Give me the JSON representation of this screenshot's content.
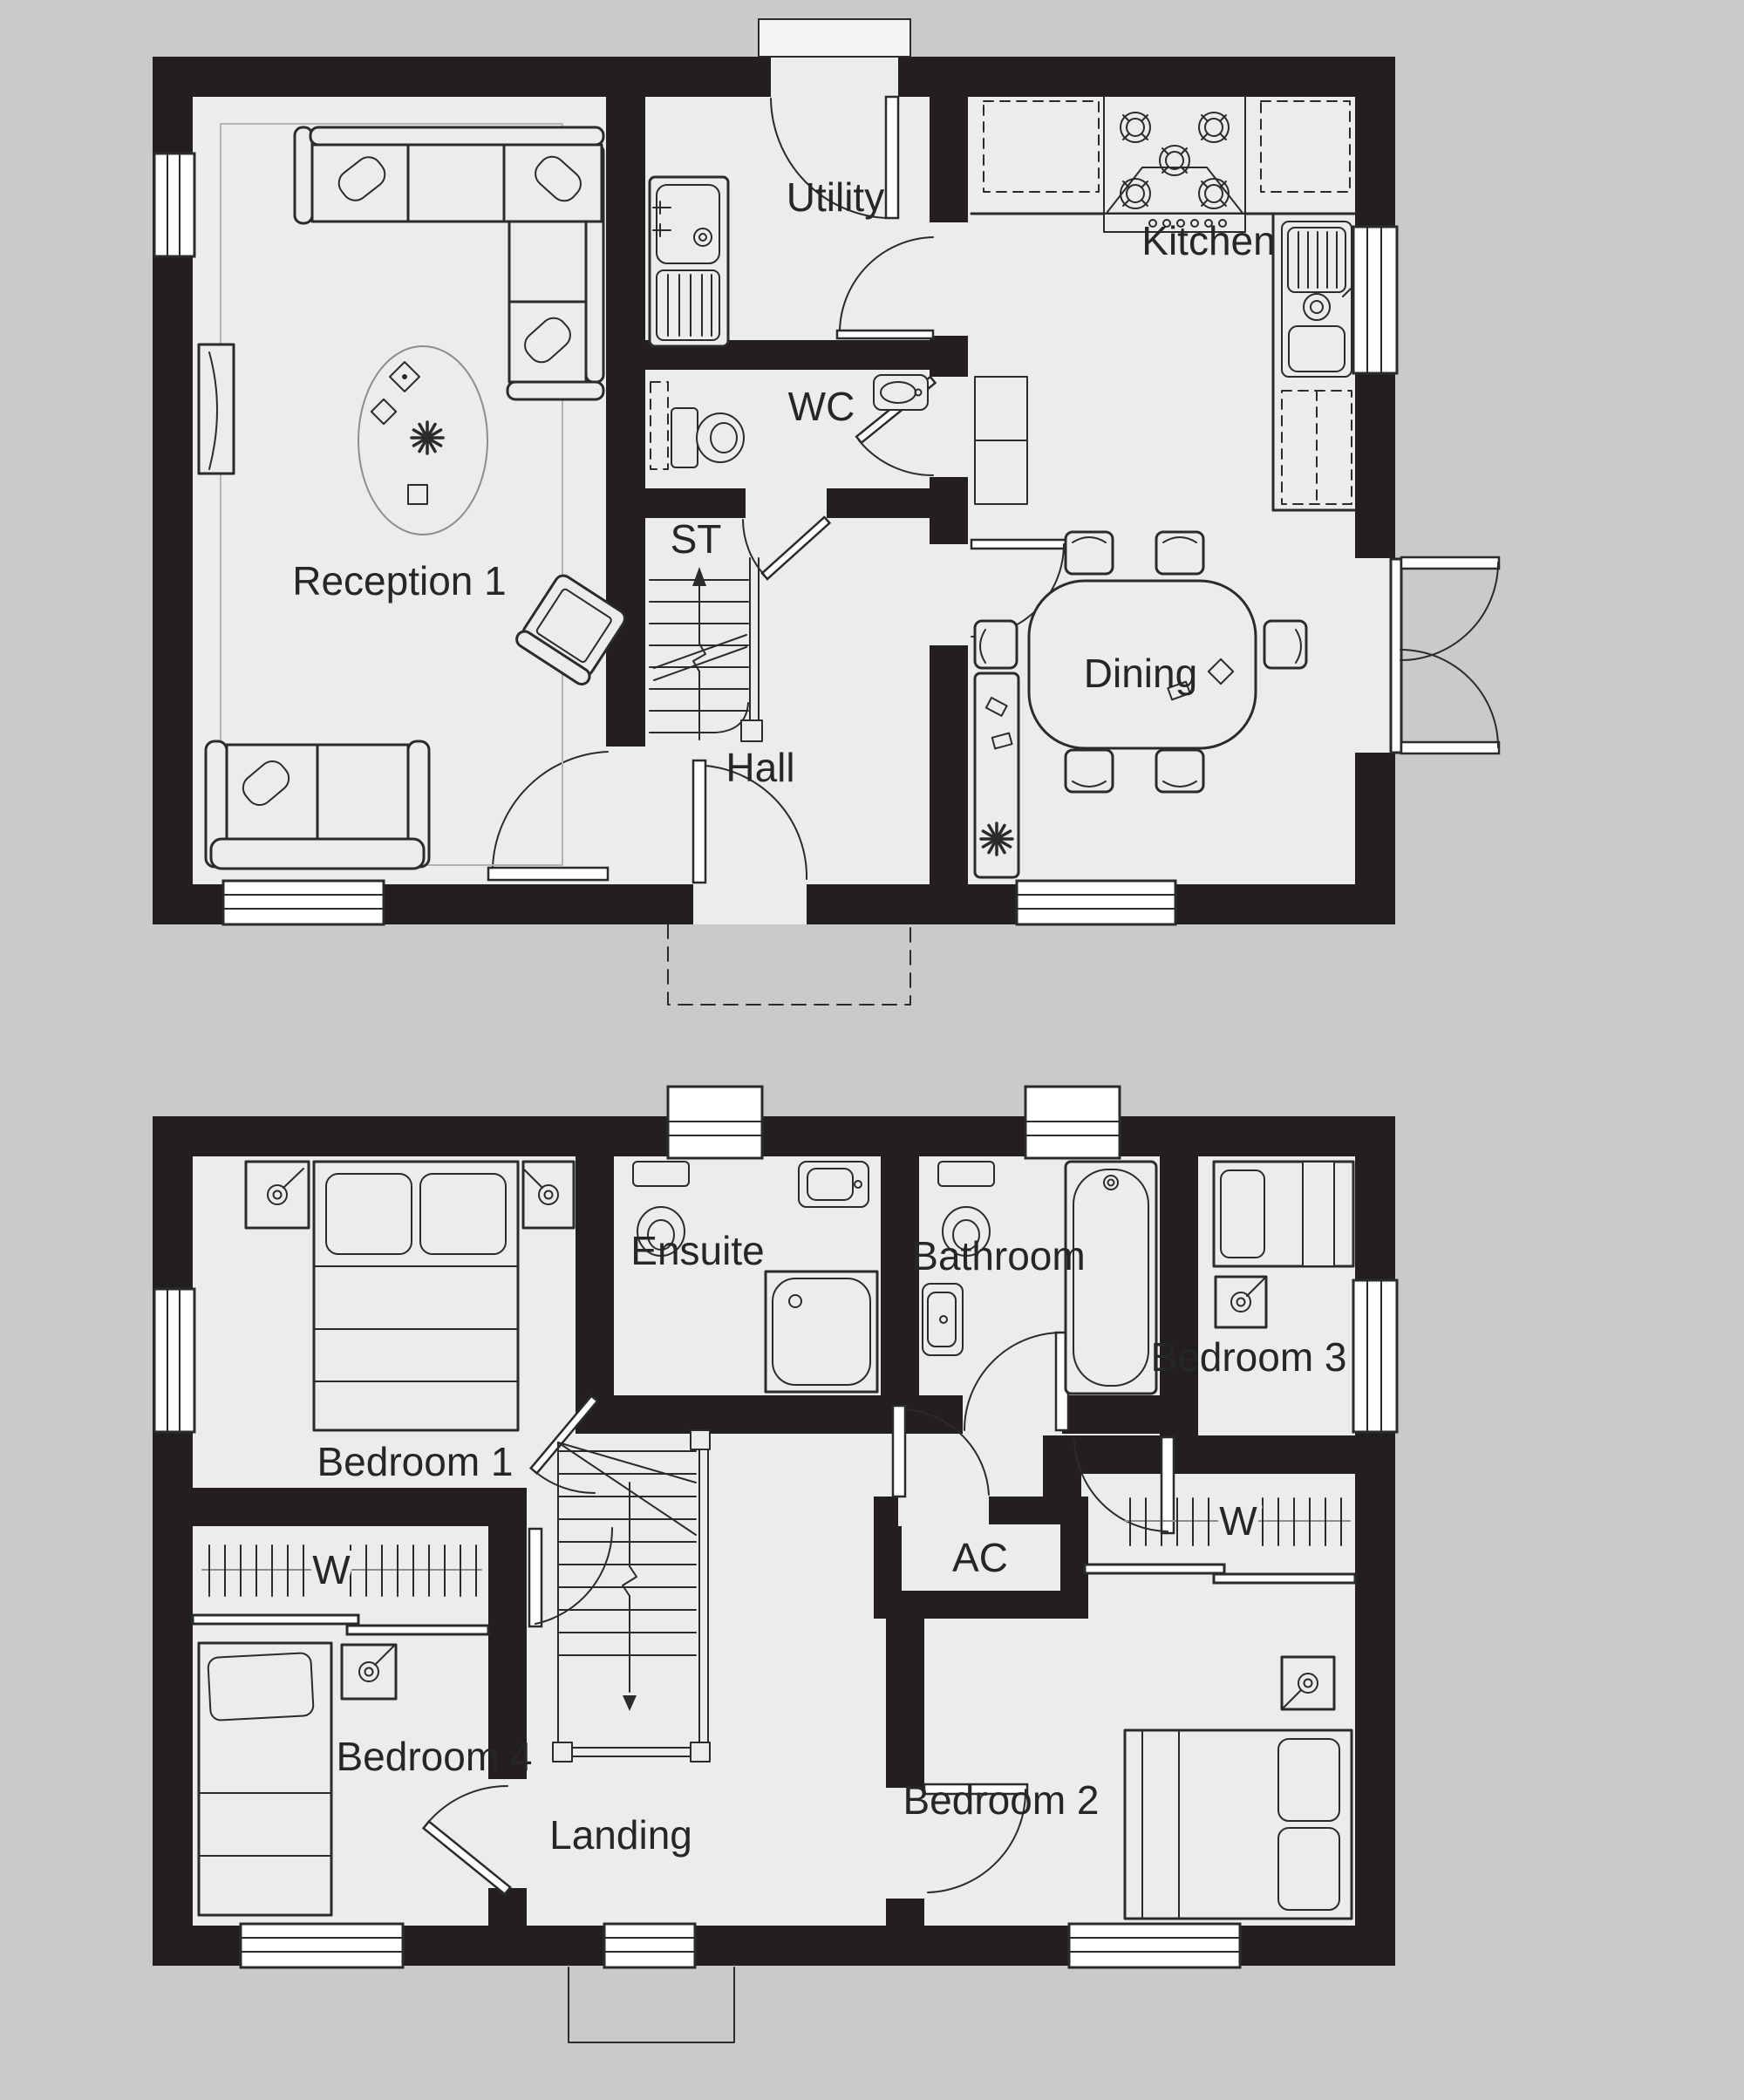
{
  "palette": {
    "background": "#cacaca",
    "floor_fill": "#ececec",
    "wall_fill": "#231f20",
    "line": "#2b2b2b",
    "window_fill": "#ffffff",
    "rug_outline": "#8d8d8d"
  },
  "floors": {
    "ground": {
      "rooms": [
        {
          "label": "Reception 1"
        },
        {
          "label": "Utility"
        },
        {
          "label": "WC"
        },
        {
          "label": "ST"
        },
        {
          "label": "Hall"
        },
        {
          "label": "Kitchen"
        },
        {
          "label": "Dining"
        }
      ]
    },
    "first": {
      "rooms": [
        {
          "label": "Bedroom 1"
        },
        {
          "label": "Ensuite"
        },
        {
          "label": "Bathroom"
        },
        {
          "label": "Bedroom 3"
        },
        {
          "label": "Bedroom 4"
        },
        {
          "label": "Bedroom 2"
        },
        {
          "label": "Landing"
        },
        {
          "label": "AC"
        },
        {
          "label": "W"
        },
        {
          "label": "W"
        }
      ]
    }
  }
}
